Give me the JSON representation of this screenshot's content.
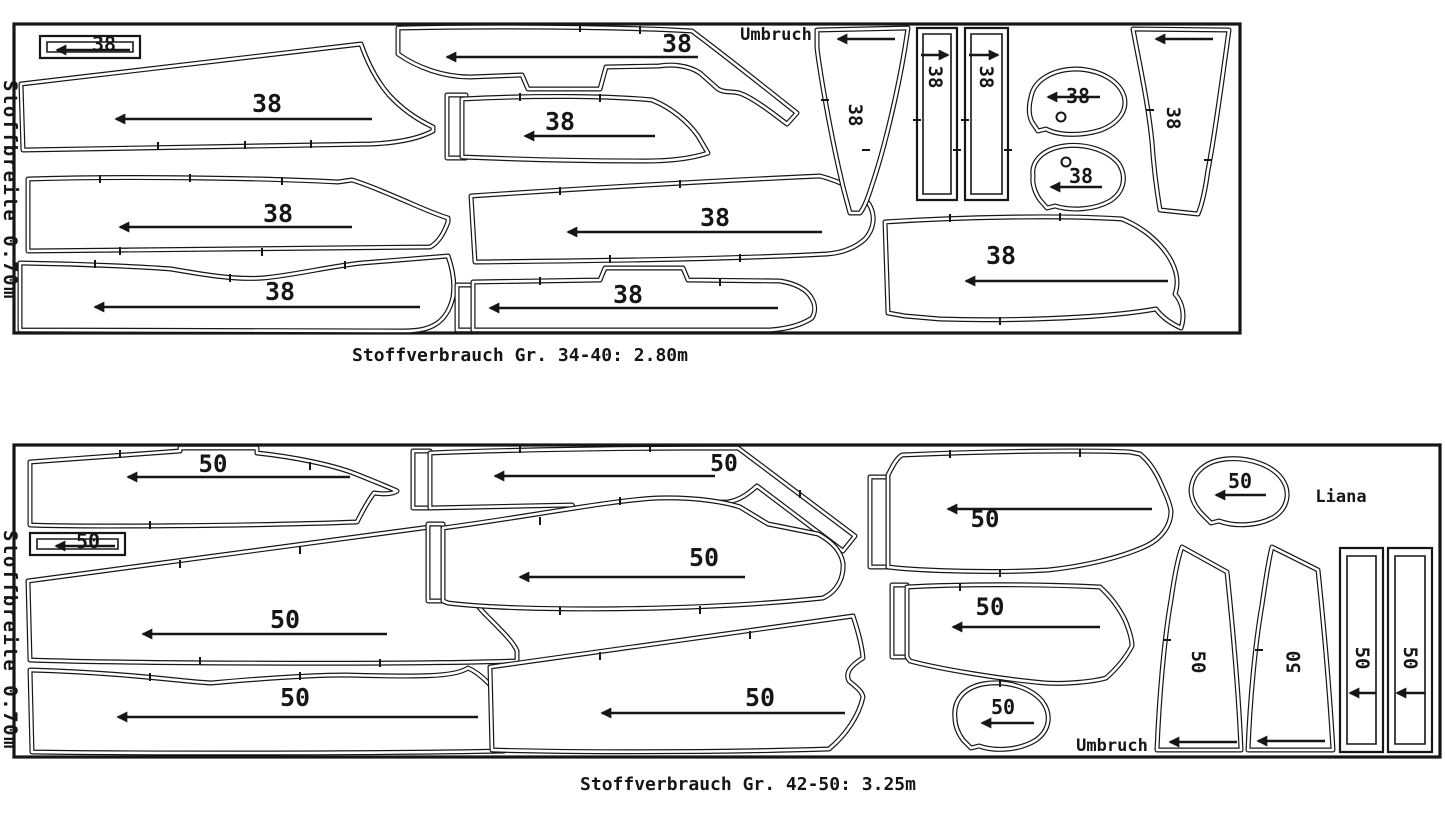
{
  "diagram": {
    "type": "sewing-pattern-cutting-layout",
    "background_color": "#ffffff",
    "line_color": "#161616"
  },
  "panels": [
    {
      "size_label": "38",
      "fabric_width_label": "Stoffbreite 0.70m",
      "fold_label": "Umbruch",
      "caption": "Stoffverbrauch Gr. 34-40: 2.80m"
    },
    {
      "size_label": "50",
      "fabric_width_label": "Stoffbreite 0.70m",
      "fold_label": "Umbruch",
      "brand_label": "Liana",
      "caption": "Stoffverbrauch Gr. 42-50: 3.25m"
    }
  ]
}
